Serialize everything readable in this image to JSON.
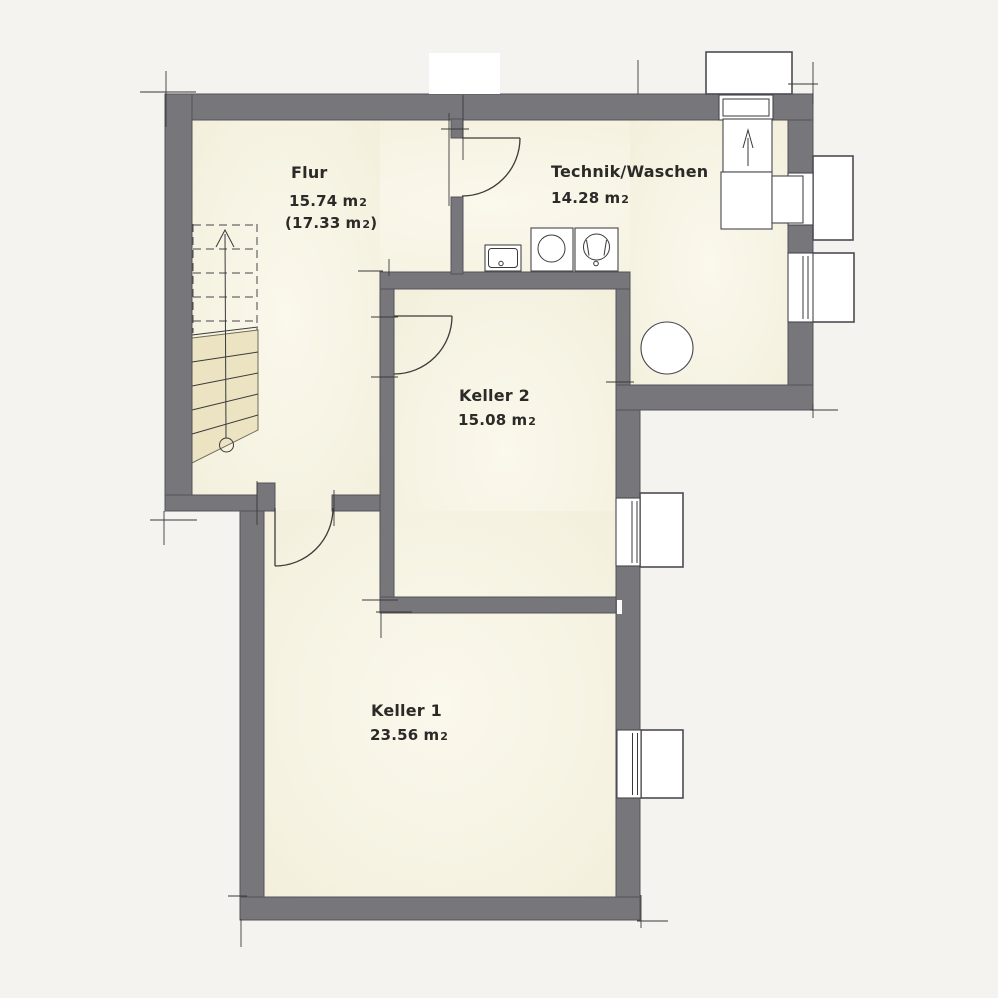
{
  "colors": {
    "background": "#f4f3f0",
    "room": "#f5f2e1",
    "wall": "#77767b",
    "wall_edge": "#54535a",
    "line": "#3a3a3a",
    "stair": "#ebe3c2",
    "white": "#ffffff"
  },
  "units": {
    "unit": "m",
    "sub": "2"
  },
  "rooms": {
    "flur": {
      "name": "Flur",
      "area": "15.74",
      "alt_prefix": "(17.33",
      "alt_suffix": ")"
    },
    "technik": {
      "name": "Technik/Waschen",
      "area": "14.28"
    },
    "keller2": {
      "name": "Keller 2",
      "area": "15.08"
    },
    "keller1": {
      "name": "Keller 1",
      "area": "23.56"
    }
  },
  "fixtures": {
    "sink": "utility-sink",
    "washer": "washing-machine",
    "dryer": "dryer",
    "boiler": "boiler-tank",
    "stairs": "staircase-up",
    "doors": "door-swing",
    "windows": "basement-window",
    "light_wells": "light-well"
  }
}
